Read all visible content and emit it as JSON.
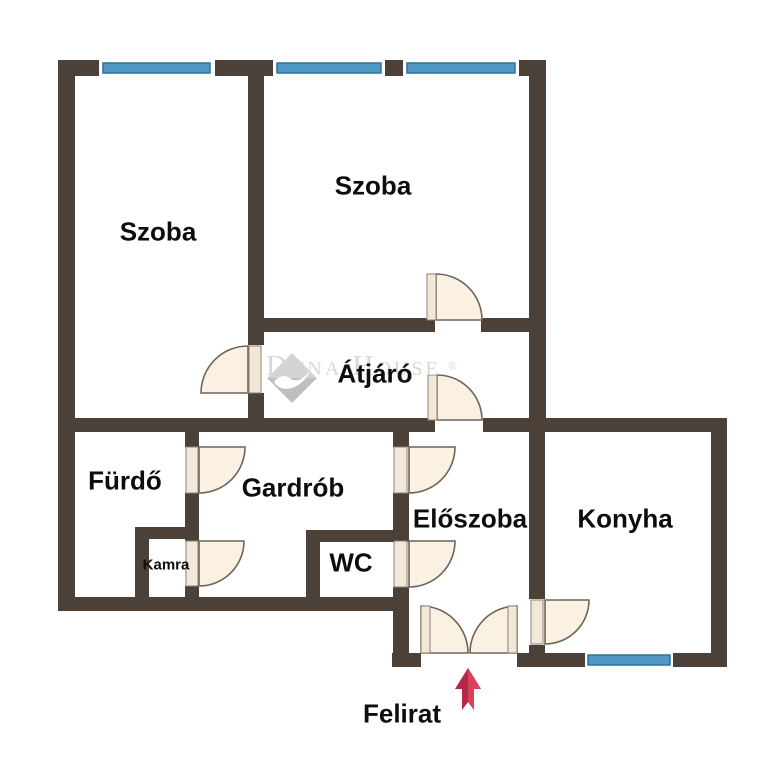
{
  "floorplan": {
    "rooms": {
      "szoba_left": {
        "label": "Szoba"
      },
      "szoba_right": {
        "label": "Szoba"
      },
      "atjaro": {
        "label": "Átjáró"
      },
      "furdo": {
        "label": "Fürdő"
      },
      "gardrob": {
        "label": "Gardrób"
      },
      "kamra": {
        "label": "Kamra"
      },
      "wc": {
        "label": "WC"
      },
      "eloszoba": {
        "label": "Előszoba"
      },
      "konyha": {
        "label": "Konyha"
      }
    },
    "caption": {
      "label": "Felirat"
    },
    "watermark": {
      "brand": "Duna House",
      "registered_mark": "®"
    },
    "colors": {
      "wall": "#4b4138",
      "window_fill": "#4f97c5",
      "window_border": "#2f719c",
      "door_fill": "#faf1e2",
      "door_stroke": "#6f6459",
      "arrow_red_dark": "#b52747",
      "arrow_red_light": "#d8415c",
      "watermark_gray": "#d8d8d8",
      "label_text": "#0d0d0d",
      "background": "#ffffff"
    }
  }
}
